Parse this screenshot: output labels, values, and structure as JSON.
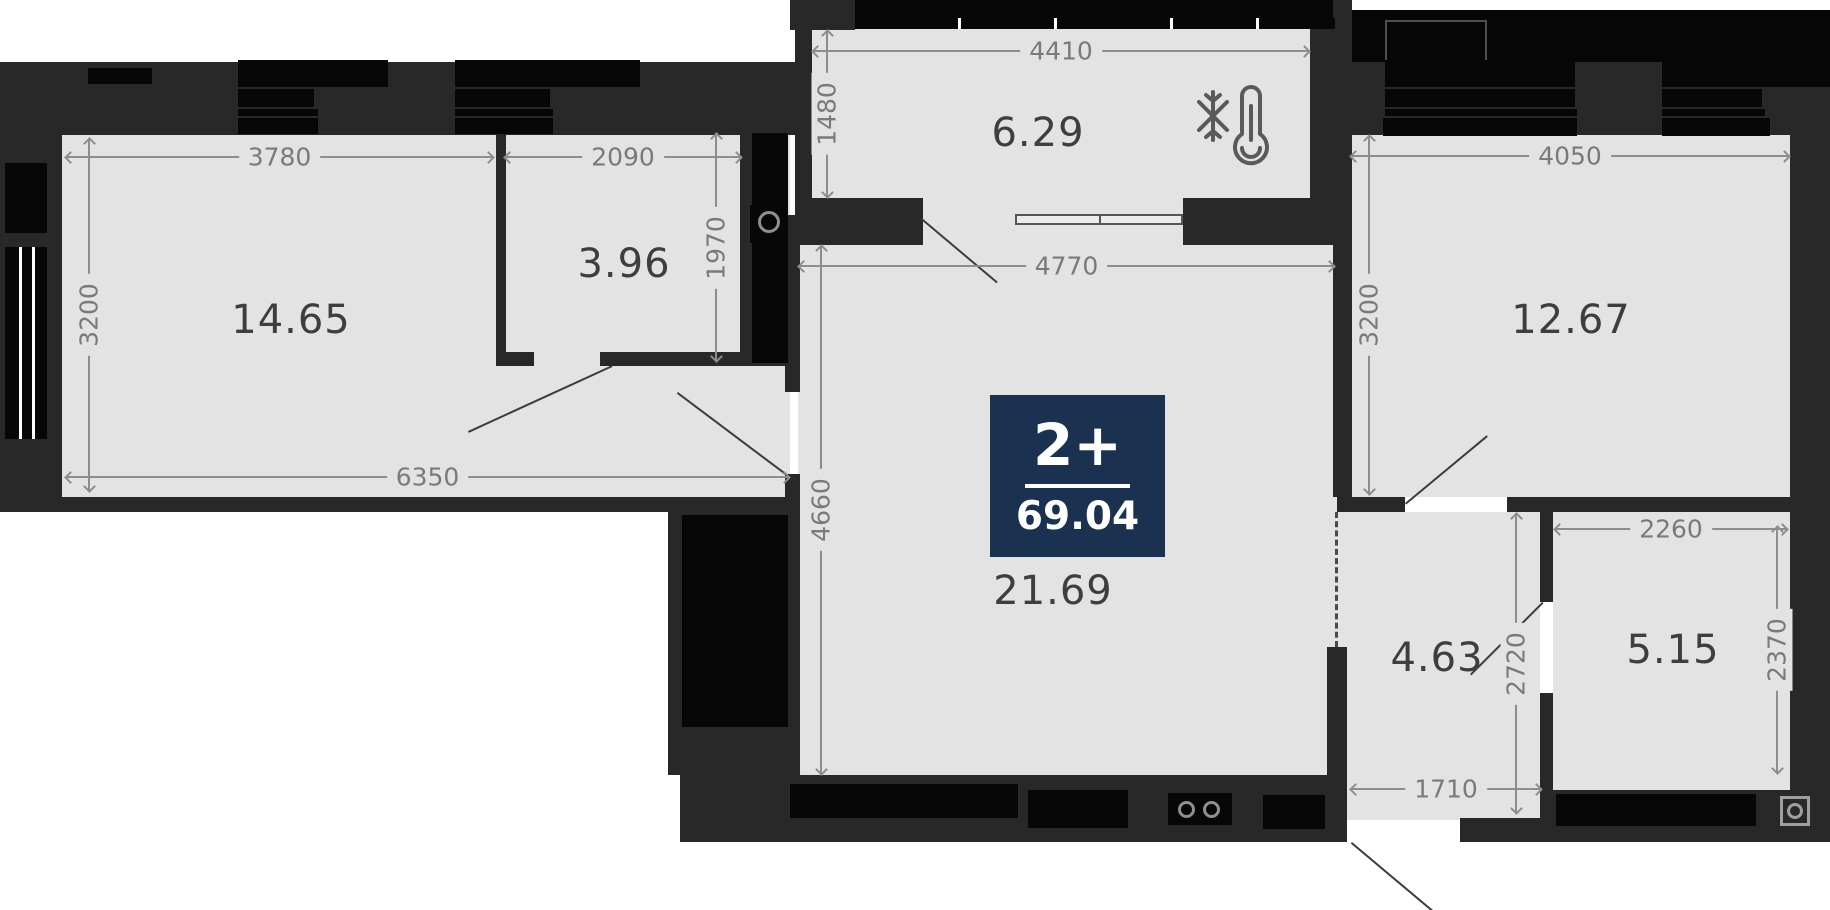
{
  "plan": {
    "badge": {
      "type_label": "2+",
      "total_area": "69.04"
    },
    "rooms": {
      "room_14_65": {
        "area": "14.65"
      },
      "room_3_96": {
        "area": "3.96"
      },
      "balcony": {
        "area": "6.29"
      },
      "room_12_67": {
        "area": "12.67"
      },
      "living": {
        "area": "21.69"
      },
      "hall": {
        "area": "4.63"
      },
      "bath": {
        "area": "5.15"
      }
    },
    "dims": {
      "d3780": "3780",
      "d2090": "2090",
      "d3200_left": "3200",
      "d1970": "1970",
      "d6350": "6350",
      "d4410": "4410",
      "d1480": "1480",
      "d4770": "4770",
      "d4660": "4660",
      "d4050": "4050",
      "d3200_right": "3200",
      "d2260": "2260",
      "d2370": "2370",
      "d2720": "2720",
      "d1710": "1710"
    },
    "icons": {
      "climate": "thermometer-snowflake-icon",
      "stove": "stove-burners-icon",
      "vent_bath": "ventilation-icon",
      "vent_shaft": "ventilation-icon"
    },
    "colors": {
      "wall": "#282828",
      "black": "#070707",
      "floor": "#e3e3e3",
      "dim_text": "#7a7a7a",
      "area_text": "#3e3e3e",
      "badge_bg": "#1b3150",
      "badge_text": "#ffffff"
    }
  }
}
